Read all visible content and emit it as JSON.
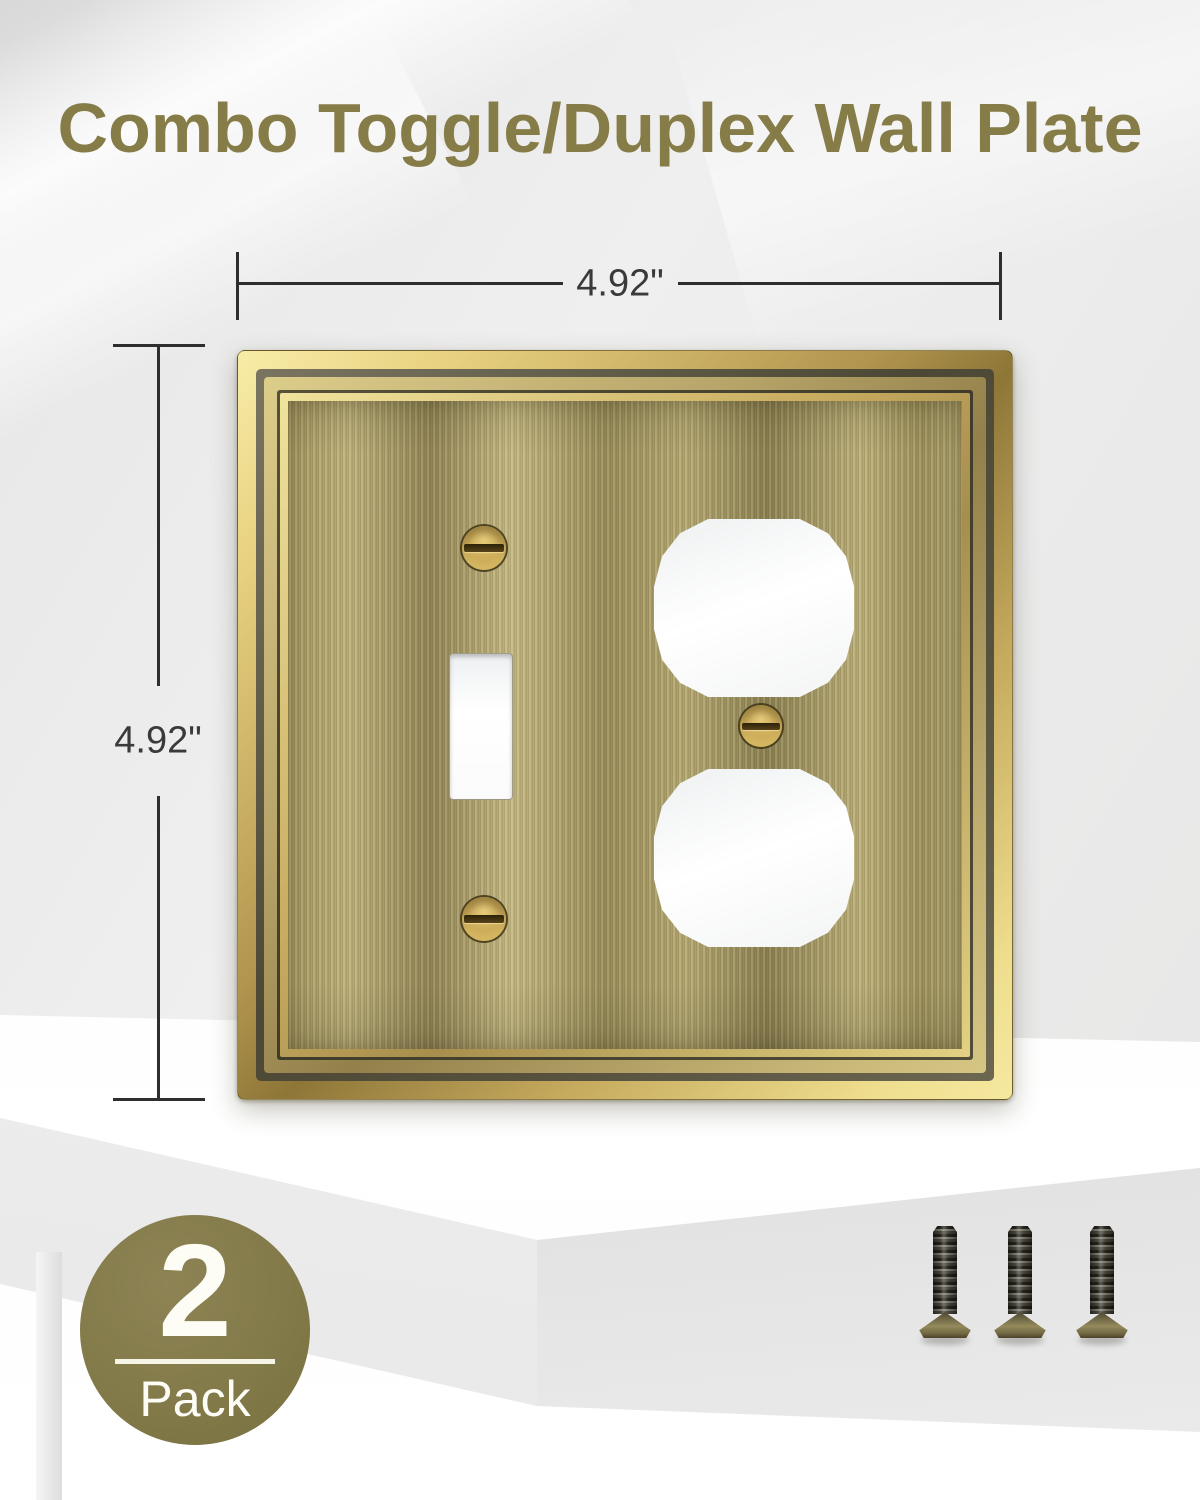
{
  "title": "Combo Toggle/Duplex Wall Plate",
  "dimensions": {
    "width_label": "4.92\"",
    "height_label": "4.92\""
  },
  "badge": {
    "count": "2",
    "label": "Pack"
  },
  "scene": {
    "product": "combo toggle/duplex wall plate, antique brushed brass with gold molded frame",
    "accessories": "three bronze mounting screws",
    "surface": "white display pedestal"
  },
  "icons": {
    "wall_plate": "plate-photo",
    "toggle_cutout": "toggle-slot-shape",
    "duplex_cutout": "rounded-octagon-shape",
    "screw": "slotted-round-screw",
    "mounting_screw": "flat-head-threaded-screw"
  },
  "colors": {
    "background": "#ececec",
    "title_text": "#867c48",
    "badge_olive": "#837a4a",
    "badge_text": "#fdfdf6",
    "frame_gold": "#d9bf6f",
    "frame_groove": "#4c4835",
    "plate_brass": "#a89a66",
    "cutout_white": "#ffffff",
    "screw_brass": "#cfae5c",
    "dimension_line": "#2e2e2e",
    "dimension_text": "#3a3a3a"
  }
}
